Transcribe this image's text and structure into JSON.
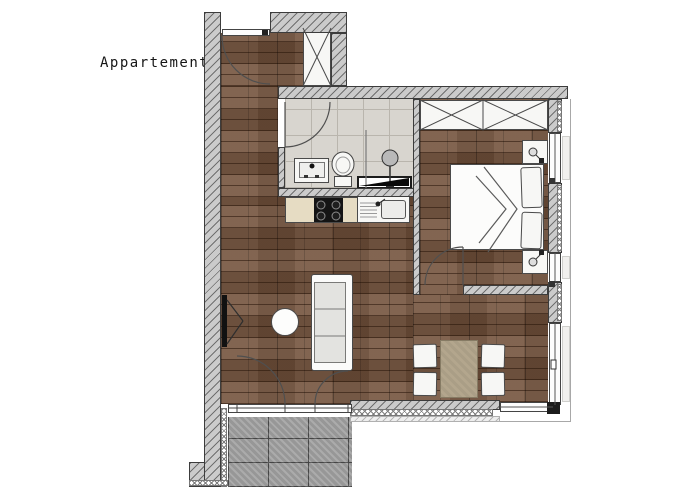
{
  "title": "Appartement 4",
  "colors": {
    "wood": "#71503a",
    "wall_fill": "#cbcbcb",
    "wall_hatch": "#6f6f6f",
    "bath_tile": "#d8d5cf",
    "bath_tile_line": "#b9b5ad",
    "balcony_tile": "#a2a2a2",
    "balcony_tile_line": "#4a4a4a",
    "counter": "#e6dcc3",
    "cooktop": "#141414",
    "cushion": "#e3e3e0",
    "dining_table": "#b3a68d",
    "line_dark": "#3c3c3c"
  }
}
